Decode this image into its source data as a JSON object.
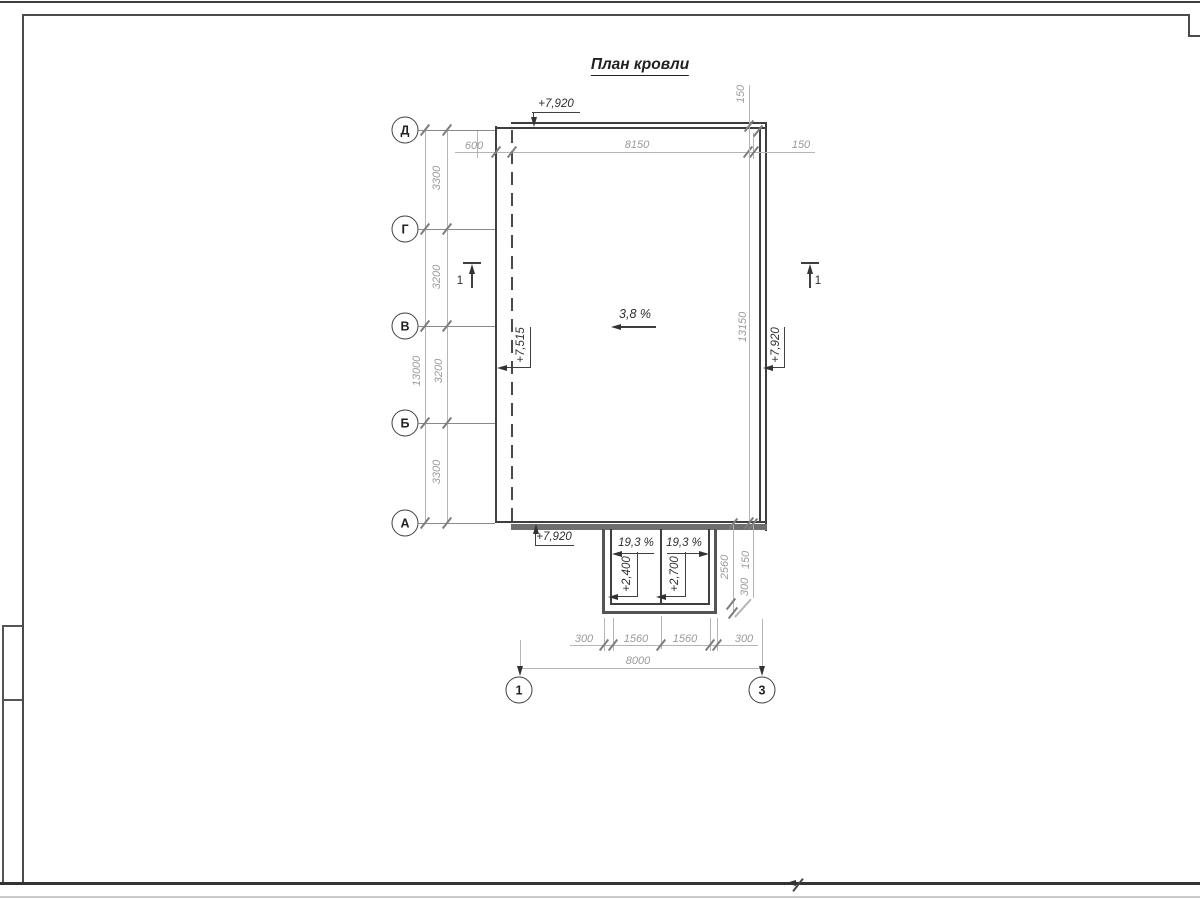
{
  "title": "План кровли",
  "axes_left": [
    "Д",
    "Г",
    "В",
    "Б",
    "А"
  ],
  "axes_bottom": [
    "1",
    "3"
  ],
  "left_dims": [
    "3300",
    "3200",
    "3200",
    "3300"
  ],
  "left_total": "13000",
  "top_dims": [
    "600",
    "8150",
    "150"
  ],
  "right_eave_dim": "150",
  "right_total": "13150",
  "canopy_side_dims": [
    "2560",
    "150",
    "300"
  ],
  "bottom_dims": [
    "300",
    "1560",
    "1560",
    "300"
  ],
  "bottom_total": "8000",
  "elevations": {
    "top": "+7,920",
    "bottom_left": "+7,920",
    "right": "+7,920",
    "ridge": "+7,515",
    "canopy_left": "+2,400",
    "canopy_right": "+2,700"
  },
  "slopes": {
    "main": "3,8 %",
    "canopy_left": "19,3 %",
    "canopy_right": "19,3 %"
  },
  "section_marks": [
    "1",
    "1"
  ],
  "colors": {
    "line_dark": "#3f3f3f",
    "line_dim": "#b5b5b5",
    "text_dim": "#9b9b9b",
    "text_dark": "#2e2e2e",
    "eave_band": "#6e6e6e"
  }
}
